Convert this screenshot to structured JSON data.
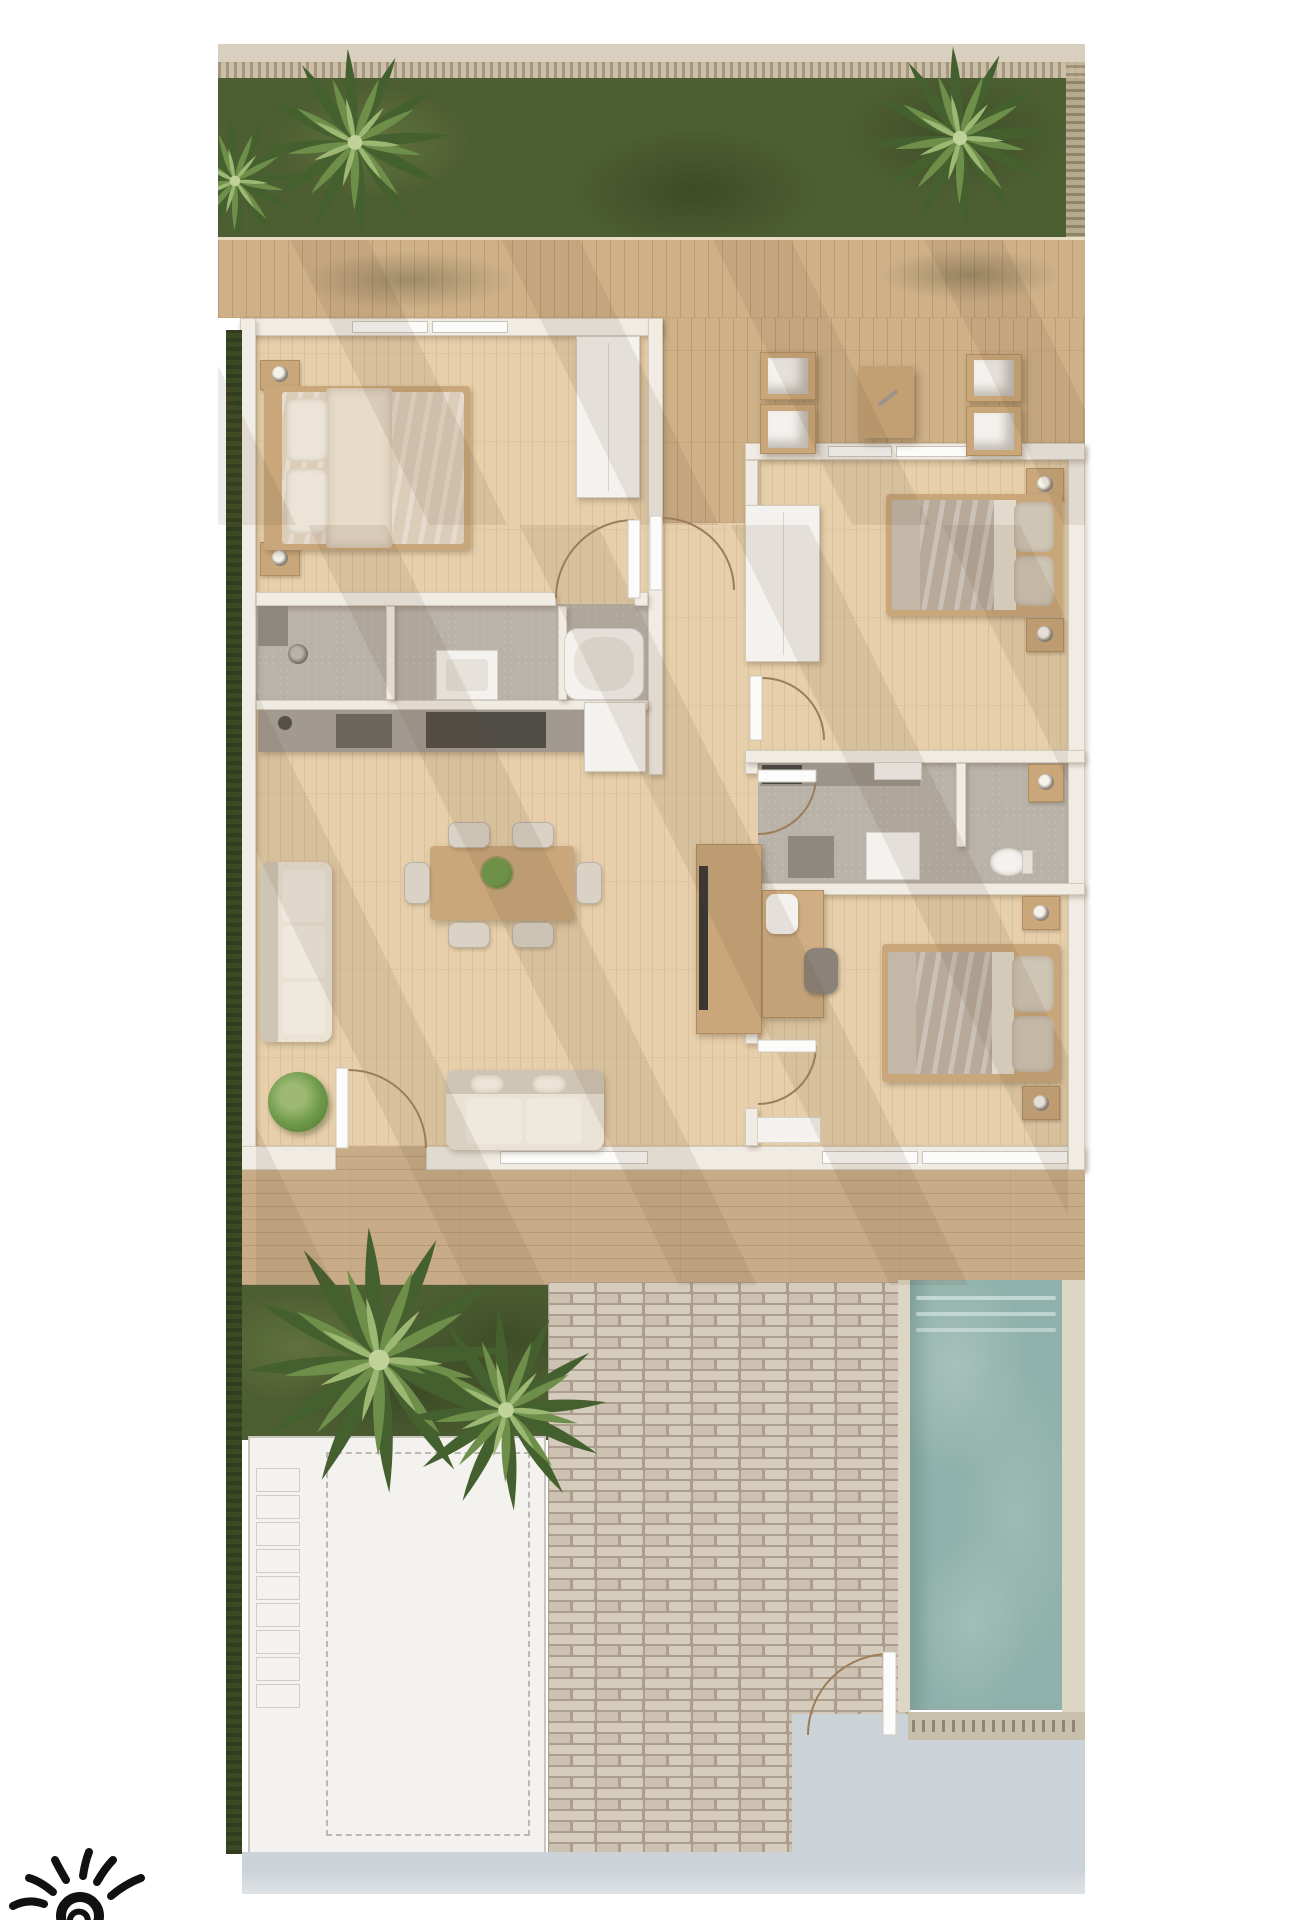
{
  "document": {
    "kind": "architectural floor plan render",
    "view": "top-down",
    "visible_text": "none"
  },
  "palette": {
    "bg": "#ffffff",
    "eave": "#d9cfbf",
    "slat-dark": "#9a8b72",
    "slat-light": "#c6b89e",
    "lawn": "#4e5e33",
    "lawn-dark": "#36431f",
    "lawn-light": "#697c41",
    "palm-dark": "#44602e",
    "palm-mid": "#6e8f4a",
    "palm-light": "#9cb873",
    "palm-tip": "#c0d29a",
    "deck": "#cfb188",
    "deck-south": "#c8ac87",
    "floor": "#e6cfaa",
    "wall": "#f0ece4",
    "wall-edge": "#d3cbbd",
    "window": "#fbfbf9",
    "gray-floor": "#b9b2a9",
    "counter": "#a29a91",
    "appliance": "#6b655e",
    "appliance-dark": "#514d47",
    "white-f": "#f4f2ee",
    "fixture-inner": "#e6e2db",
    "sofa": "#e9e2d5",
    "sofa-shadow": "#cfc5b4",
    "cushion": "#efe9dd",
    "wood-f": "#c9a77b",
    "wood-dark": "#b08c5f",
    "duvet-m": "#dccdb9",
    "duvet-g": "#b7aa9b",
    "pillow-m": "#ece4d6",
    "pillow-g": "#cfc5b5",
    "sheet": "#e2dacc",
    "tv": "#3a3732",
    "chair-dark": "#8b8379",
    "plant": "#6f9a4a",
    "plant-dark": "#4d7231",
    "pool": "#90b1ab",
    "coping": "#ded6c5",
    "grate": "#c9c0ab",
    "grate-line": "#8f8672",
    "brick-mortar": "#ab9e8c",
    "brick": "#d6ccbd",
    "brick2": "#cdc2b1",
    "drive": "#f3f2ef",
    "drive-edge": "#c9c6bf",
    "dash": "#bcb9b1",
    "pave": "#ccd3d8",
    "hedge": "#3c4a24",
    "arc": "#9b7e58",
    "logo": "#111111"
  },
  "site": {
    "north_garden": {
      "lawn": true,
      "palm_trees": 3,
      "roof_eave_strip": true,
      "slat_fence_top": true,
      "slat_fence_right": true
    },
    "north_deck": {
      "material": "timber planks",
      "outdoor_lounge": {
        "armchairs": 4,
        "side_table": 1
      }
    },
    "south_deck": {
      "material": "timber planks"
    },
    "south_garden": {
      "lawn": true,
      "palm_trees": 2,
      "hedge_strip_left": true
    },
    "driveway": {
      "surface": "white concrete",
      "dashed_parking_outline": true,
      "side_pads": 9
    },
    "brick_patio": {
      "surface": "running-bond brick",
      "gate_swing": true
    },
    "pool": {
      "water": "teal",
      "entry_steps": 3,
      "stone_coping": true,
      "drain_grate": true
    },
    "street_pavement": {
      "color": "light blue-gray"
    }
  },
  "house": {
    "rooms": [
      {
        "id": "master-bedroom",
        "furniture": [
          "double bed",
          "2 pillows",
          "duvet",
          "2 nightstands",
          "2 lamps",
          "wardrobe"
        ]
      },
      {
        "id": "master-bathroom",
        "furniture": [
          "walk-in shower",
          "vanity basin",
          "bathtub",
          "2 glass dividers"
        ]
      },
      {
        "id": "kitchen",
        "furniture": [
          "counter run",
          "cooktop",
          "sink",
          "tall cabinet"
        ]
      },
      {
        "id": "living-dining",
        "furniture": [
          "wall sofa",
          "loveseat",
          "dining table",
          "6 chairs",
          "table plant",
          "potted plant",
          "tv console",
          "desk",
          "2 desk chairs",
          "door mat"
        ]
      },
      {
        "id": "hallway",
        "furniture": []
      },
      {
        "id": "bedroom-2",
        "furniture": [
          "double bed",
          "2 pillows",
          "2 nightstands",
          "2 lamps",
          "wardrobe"
        ]
      },
      {
        "id": "bathroom-2",
        "furniture": [
          "counter",
          "shower tray",
          "toilet",
          "cabinet",
          "wood cabinet"
        ]
      },
      {
        "id": "bedroom-3",
        "furniture": [
          "double bed",
          "2 pillows",
          "2 nightstands",
          "2 lamps"
        ]
      }
    ],
    "terrace": {
      "location": "top-right",
      "open_air": true
    },
    "door_swings": 7,
    "windows": 7
  },
  "logo": {
    "motif": "hand-drawn sun: spiral center with radiating brush rays",
    "color": "#111111",
    "position": "bottom-left corner",
    "clipped_by_page_edge": true
  }
}
